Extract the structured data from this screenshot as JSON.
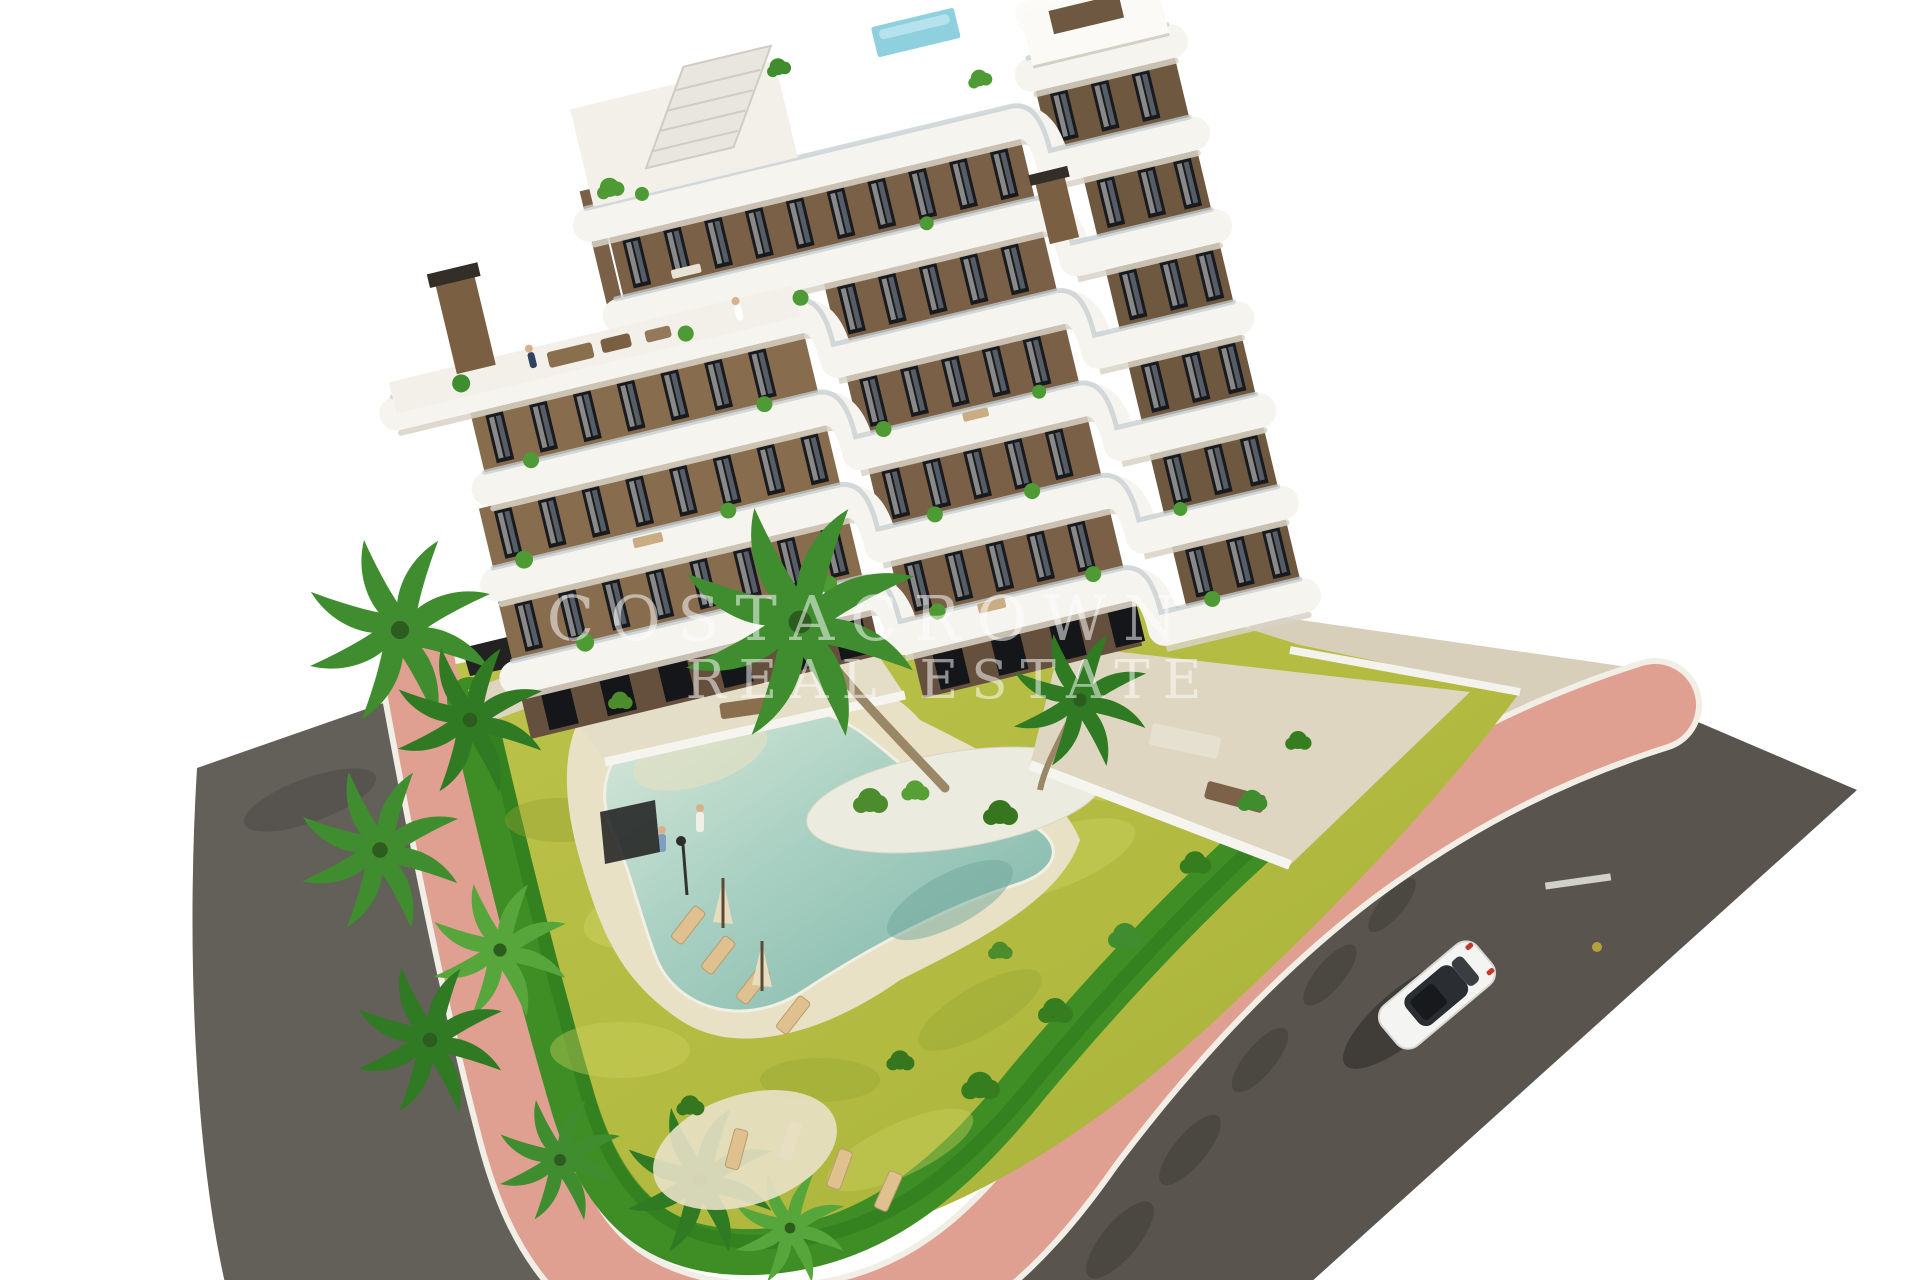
{
  "watermark": {
    "line1": "COSTACROWN",
    "line2": "REAL ESTATE"
  },
  "scene": {
    "setting": "aerial 3D architectural render of a modern terraced apartment complex with garden, free-form pool and surrounding streets",
    "background": "#ffffff",
    "building": {
      "floors": 7,
      "facade_color": "#81674a",
      "balcony_color": "#f6f4ef",
      "window_color": "#181a1e",
      "features": [
        "stepped white wrap-around balconies",
        "rooftop glass plunge pool",
        "external roof stair",
        "brown chimneys",
        "balcony plants",
        "roof lounge furniture",
        "tiny people on terraces"
      ]
    },
    "garden": {
      "lawn_color": "#b5bd43",
      "hedge_color": "#3e8d25",
      "sand_color": "#e9e1c6",
      "features": [
        "free-form swimming pool with beach entry",
        "wooden sun loungers",
        "cream parasols",
        "palm trees",
        "white pebble island",
        "lamp post",
        "black garden gate"
      ]
    },
    "pool": {
      "water_color": "#8ec3b6",
      "water_edge_color": "#d9e8da"
    },
    "roads": {
      "asphalt_left": "#635f59",
      "asphalt_right": "#59554e",
      "walkway_color": "#df9f91",
      "curb_color": "#f1eee6",
      "sidewalk_color": "#d7cfba",
      "lane_marking": "short white dash"
    },
    "vehicles": [
      {
        "type": "car",
        "color": "white",
        "color_hex": "#f4f4f2",
        "roof_color": "#2a2d31",
        "position": "driving on right road",
        "detail": "red taillights, dark sunroof, shadow cast to lower-left"
      }
    ]
  }
}
